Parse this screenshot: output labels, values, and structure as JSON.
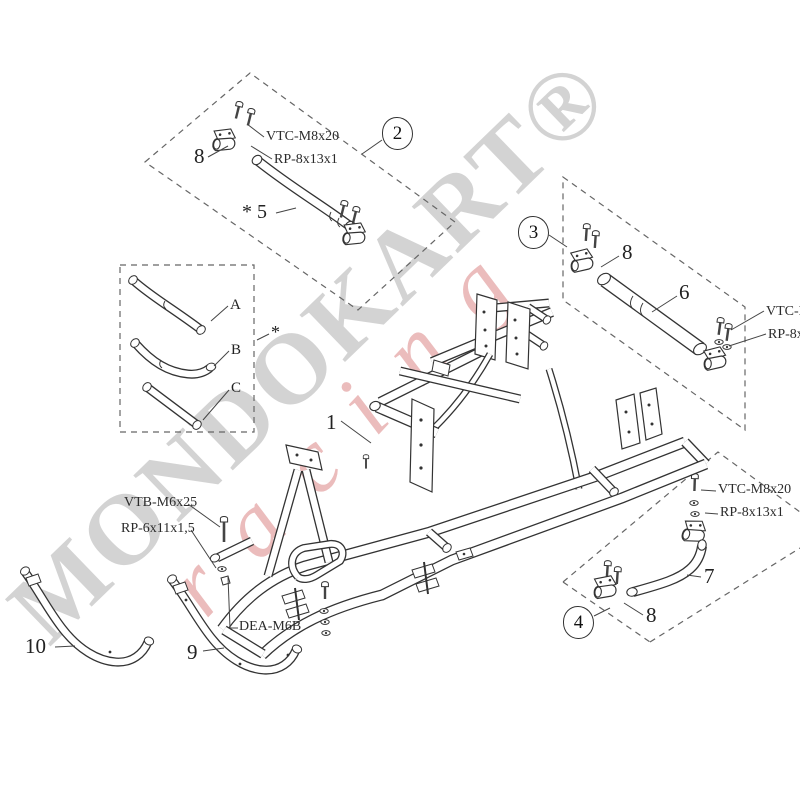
{
  "watermark": {
    "main": "MONDOKART®",
    "accent": "racing",
    "gray_color": "#919191",
    "red_color": "#c84b4b"
  },
  "callouts": {
    "c2": "2",
    "c3": "3",
    "c4": "4"
  },
  "item_numbers": {
    "n1": "1",
    "n5": "* 5",
    "n6": "6",
    "n7": "7",
    "n8a": "8",
    "n8b": "8",
    "n8c": "8",
    "n9": "9",
    "n10": "10"
  },
  "variant_letters": {
    "a": "A",
    "b": "B",
    "c": "C",
    "star_box": "*"
  },
  "part_codes": {
    "vtc2": "VTC-M8x20",
    "rp2": "RP-8x13x1",
    "vtc3": "VTC-M8x20",
    "rp3": "RP-8x13x1",
    "vtc4": "VTC-M8x20",
    "rp4": "RP-8x13x1",
    "vtb": "VTB-M6x25",
    "rp6": "RP-6x11x1,5",
    "dea": "DEA-M6B"
  }
}
